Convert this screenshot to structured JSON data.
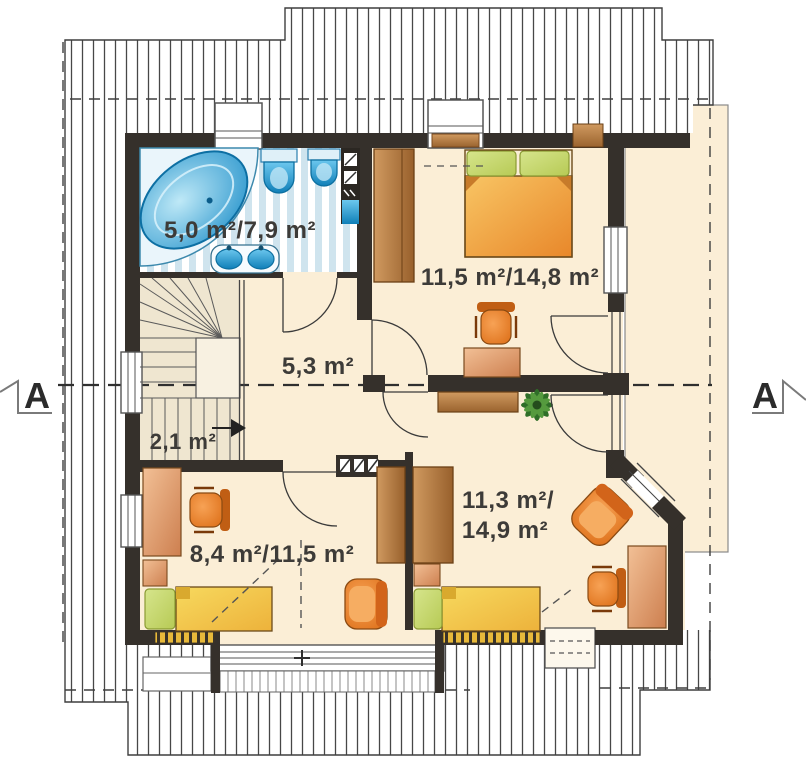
{
  "plan": {
    "rooms": {
      "bathroom": {
        "area_label": "5,0 m²/7,9 m²"
      },
      "bedroom_top_right": {
        "area_label": "11,5 m²/14,8 m²"
      },
      "hall": {
        "area_label": "5,3 m²"
      },
      "staircase": {
        "area_label": "2,1 m²"
      },
      "bedroom_bottom_left": {
        "area_label": "8,4 m²/11,5 m²"
      },
      "bedroom_bottom_right": {
        "area_label_line1": "11,3 m²/",
        "area_label_line2": "14,9 m²"
      }
    },
    "section_markers": {
      "left": "A",
      "right": "A"
    },
    "colors": {
      "floor": "#fbeed6",
      "wall": "#35302b",
      "bathroom_tile": "#cfe4ee",
      "fixture_blue": "#2aa6dd",
      "wood": "#b5773f",
      "bed_orange": "#ec8f2b",
      "bed_yellow": "#f0bb3f",
      "pillow_green": "#cadb72",
      "chair_orange": "#e87f2e"
    }
  }
}
